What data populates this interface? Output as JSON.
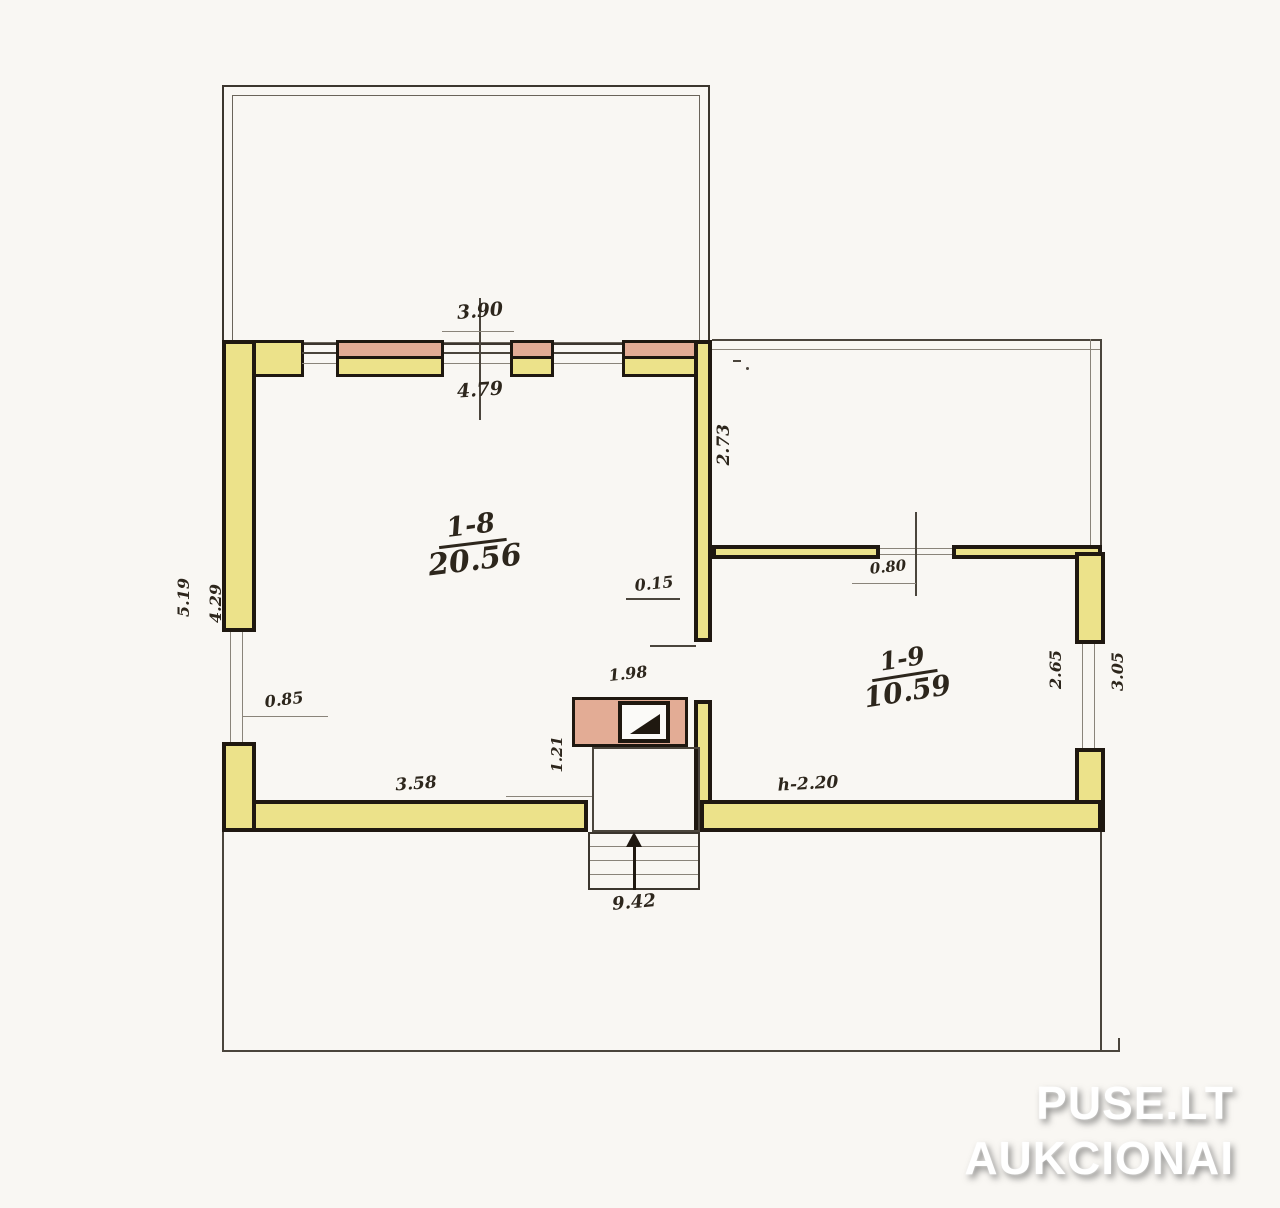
{
  "rooms": [
    {
      "id": "1-8",
      "area": "20.56"
    },
    {
      "id": "1-9",
      "area": "10.59"
    }
  ],
  "dimensions": {
    "top_window_width": "3.90",
    "top_wall_inner": "4.79",
    "right_area_depth": "2.73",
    "partition_thickness": "0.15",
    "opening_width": "0.80",
    "left_outer": "5.19",
    "left_inner": "4.29",
    "left_window": "0.85",
    "stove_width": "1.98",
    "hall_width": "1.21",
    "bottom_left_wall": "3.58",
    "ceiling_height": "h-2.20",
    "right_wall_inner": "2.65",
    "right_wall_outer": "3.05",
    "total_width": "9.42"
  },
  "watermark": {
    "line1": "PUSE.LT",
    "line2": "AUKCIONAI"
  },
  "colors": {
    "paper": "#f9f7f3",
    "ink": "#1f1810",
    "wall_fill": "#ece28a",
    "window_fill": "#e3ac95"
  }
}
